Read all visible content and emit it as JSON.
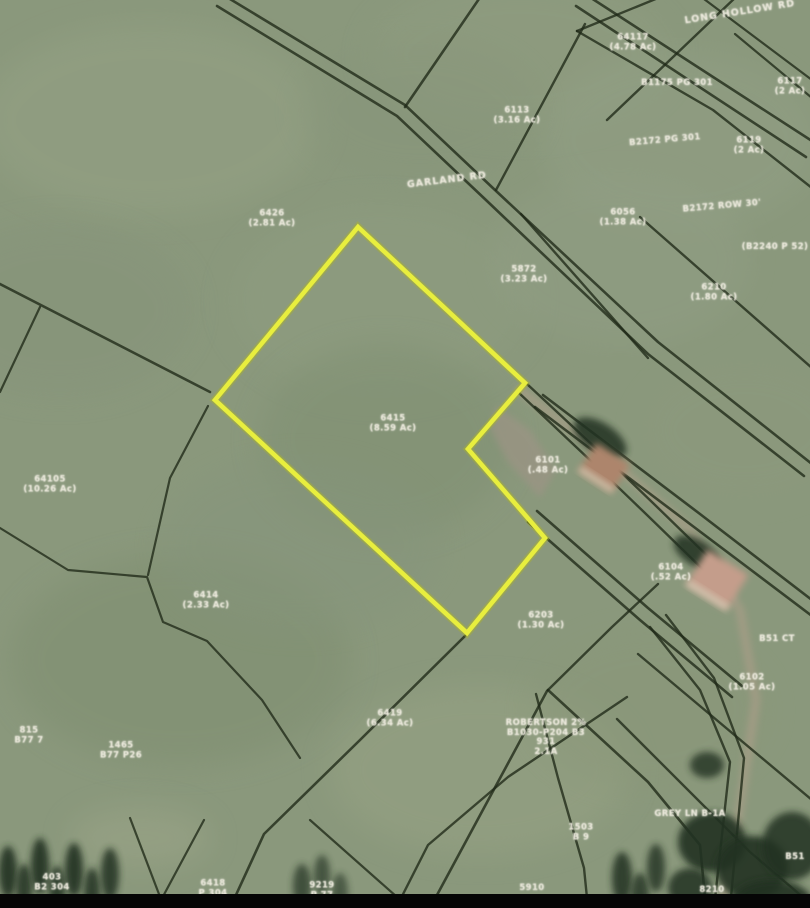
{
  "map": {
    "width": 810,
    "height": 908,
    "colors": {
      "field_base": "#8a987c",
      "boundary_line": "#1f2917",
      "highlight_yellow": "#e8ee3e",
      "highlight_glow": "#aab32a",
      "road_surface": "#a59d86",
      "driveway_grey": "#9b9484",
      "tree_dark": "#243120",
      "roof_1": "#ad856c",
      "roof_2": "#c49d8b",
      "roof_edge": "#d9d2bc",
      "bottom_bar": "#060606",
      "label_text": "#ece9dc"
    },
    "field_blobs": [
      {
        "x": 150,
        "y": 120,
        "rx": 170,
        "ry": 95,
        "fill": "#94a184",
        "o": 0.55
      },
      {
        "x": 520,
        "y": 55,
        "rx": 150,
        "ry": 75,
        "fill": "#909d81",
        "o": 0.5
      },
      {
        "x": 60,
        "y": 310,
        "rx": 130,
        "ry": 85,
        "fill": "#85937a",
        "o": 0.5
      },
      {
        "x": 680,
        "y": 140,
        "rx": 140,
        "ry": 90,
        "fill": "#93a086",
        "o": 0.45
      },
      {
        "x": 380,
        "y": 300,
        "rx": 150,
        "ry": 95,
        "fill": "#8e9c80",
        "o": 0.5
      },
      {
        "x": 385,
        "y": 440,
        "rx": 125,
        "ry": 95,
        "fill": "#7f8f72",
        "o": 0.5
      },
      {
        "x": 620,
        "y": 260,
        "rx": 130,
        "ry": 85,
        "fill": "#929f85",
        "o": 0.45
      },
      {
        "x": 745,
        "y": 430,
        "rx": 105,
        "ry": 70,
        "fill": "#8d9a7e",
        "o": 0.45
      },
      {
        "x": 180,
        "y": 660,
        "rx": 170,
        "ry": 105,
        "fill": "#7e8d70",
        "o": 0.5
      },
      {
        "x": 300,
        "y": 545,
        "rx": 140,
        "ry": 85,
        "fill": "#85947b",
        "o": 0.45
      },
      {
        "x": 480,
        "y": 770,
        "rx": 150,
        "ry": 85,
        "fill": "#97a384",
        "o": 0.5
      },
      {
        "x": 140,
        "y": 838,
        "rx": 70,
        "ry": 30,
        "fill": "#9da689",
        "o": 0.5
      },
      {
        "x": 650,
        "y": 710,
        "rx": 120,
        "ry": 80,
        "fill": "#8a9779",
        "o": 0.45
      },
      {
        "x": 420,
        "y": 110,
        "rx": 120,
        "ry": 70,
        "fill": "#87957a",
        "o": 0.4
      }
    ],
    "road_strip": {
      "points": [
        [
          520,
          390
        ],
        [
          610,
          460
        ],
        [
          690,
          530
        ],
        [
          740,
          610
        ],
        [
          756,
          700
        ],
        [
          738,
          820
        ],
        [
          722,
          908
        ]
      ],
      "width": 9
    },
    "driveway": {
      "points": [
        [
          497,
          406
        ],
        [
          530,
          430
        ],
        [
          556,
          470
        ],
        [
          540,
          498
        ],
        [
          508,
          462
        ],
        [
          490,
          428
        ]
      ]
    },
    "boundary_lines": [
      {
        "p": [
          [
            225,
            -4
          ],
          [
            405,
            105
          ],
          [
            495,
            190
          ],
          [
            658,
            342
          ],
          [
            812,
            464
          ]
        ],
        "w": 2.6
      },
      {
        "p": [
          [
            217,
            6
          ],
          [
            397,
            116
          ],
          [
            487,
            201
          ],
          [
            648,
            354
          ],
          [
            804,
            476
          ]
        ],
        "w": 2.6
      },
      {
        "p": [
          [
            588,
            -4
          ],
          [
            812,
            141
          ]
        ],
        "w": 2.6
      },
      {
        "p": [
          [
            576,
            6
          ],
          [
            806,
            157
          ]
        ],
        "w": 2.6
      },
      {
        "p": [
          [
            543,
            395
          ],
          [
            700,
            514
          ],
          [
            812,
            600
          ]
        ],
        "w": 2.6
      },
      {
        "p": [
          [
            535,
            407
          ],
          [
            694,
            527
          ],
          [
            812,
            616
          ]
        ],
        "w": 2.6
      },
      {
        "p": [
          [
            537,
            511
          ],
          [
            648,
            608
          ],
          [
            742,
            686
          ]
        ],
        "w": 2.6
      },
      {
        "p": [
          [
            528,
            522
          ],
          [
            640,
            620
          ],
          [
            732,
            697
          ]
        ],
        "w": 2.6
      },
      {
        "p": [
          [
            666,
            615
          ],
          [
            714,
            678
          ],
          [
            744,
            758
          ],
          [
            730,
            908
          ]
        ],
        "w": 2.4
      },
      {
        "p": [
          [
            650,
            627
          ],
          [
            700,
            690
          ],
          [
            730,
            762
          ],
          [
            714,
            908
          ]
        ],
        "w": 2.4
      },
      {
        "p": [
          [
            527,
            384
          ],
          [
            600,
            452
          ],
          [
            654,
            504
          ],
          [
            726,
            574
          ]
        ],
        "w": 2.4
      },
      {
        "p": [
          [
            519,
            393
          ],
          [
            592,
            462
          ],
          [
            646,
            514
          ],
          [
            718,
            584
          ]
        ],
        "w": 2.4
      },
      {
        "p": [
          [
            0,
            284
          ],
          [
            210,
            392
          ]
        ],
        "w": 2.6
      },
      {
        "p": [
          [
            40,
            307
          ],
          [
            0,
            392
          ]
        ],
        "w": 2.2
      },
      {
        "p": [
          [
            208,
            406
          ],
          [
            170,
            478
          ],
          [
            148,
            575
          ]
        ],
        "w": 2.2
      },
      {
        "p": [
          [
            0,
            528
          ],
          [
            68,
            570
          ],
          [
            147,
            577
          ],
          [
            163,
            622
          ],
          [
            207,
            641
          ],
          [
            262,
            700
          ],
          [
            300,
            758
          ]
        ],
        "w": 2.2
      },
      {
        "p": [
          [
            465,
            636
          ],
          [
            360,
            740
          ],
          [
            264,
            834
          ],
          [
            230,
            908
          ]
        ],
        "w": 2.6
      },
      {
        "p": [
          [
            547,
            691
          ],
          [
            430,
            908
          ]
        ],
        "w": 2.6
      },
      {
        "p": [
          [
            548,
            690
          ],
          [
            648,
            782
          ],
          [
            700,
            845
          ],
          [
            706,
            908
          ]
        ],
        "w": 2.6
      },
      {
        "p": [
          [
            627,
            697
          ],
          [
            508,
            777
          ],
          [
            428,
            845
          ],
          [
            396,
            908
          ]
        ],
        "w": 2.4
      },
      {
        "p": [
          [
            536,
            694
          ],
          [
            558,
            778
          ],
          [
            584,
            868
          ],
          [
            588,
            908
          ]
        ],
        "w": 2.4
      },
      {
        "p": [
          [
            548,
            690
          ],
          [
            612,
            627
          ],
          [
            658,
            584
          ]
        ],
        "w": 2.4
      },
      {
        "p": [
          [
            521,
            214
          ],
          [
            648,
            358
          ]
        ],
        "w": 2.4
      },
      {
        "p": [
          [
            640,
            217
          ],
          [
            812,
            368
          ]
        ],
        "w": 2.4
      },
      {
        "p": [
          [
            481,
            -4
          ],
          [
            405,
            107
          ]
        ],
        "w": 2.6
      },
      {
        "p": [
          [
            585,
            24
          ],
          [
            496,
            190
          ]
        ],
        "w": 2.4
      },
      {
        "p": [
          [
            577,
            31
          ],
          [
            713,
            110
          ],
          [
            812,
            188
          ]
        ],
        "w": 2.4
      },
      {
        "p": [
          [
            607,
            120
          ],
          [
            737,
            -4
          ]
        ],
        "w": 2.4
      },
      {
        "p": [
          [
            735,
            34
          ],
          [
            812,
            98
          ]
        ],
        "w": 2.2
      },
      {
        "p": [
          [
            663,
            -4
          ],
          [
            577,
            31
          ]
        ],
        "w": 2.4
      },
      {
        "p": [
          [
            700,
            -4
          ],
          [
            812,
            80
          ]
        ],
        "w": 2.2
      },
      {
        "p": [
          [
            638,
            654
          ],
          [
            812,
            800
          ]
        ],
        "w": 2.4
      },
      {
        "p": [
          [
            617,
            719
          ],
          [
            750,
            852
          ],
          [
            812,
            905
          ]
        ],
        "w": 2.4
      },
      {
        "p": [
          [
            130,
            818
          ],
          [
            162,
            902
          ]
        ],
        "w": 2.2
      },
      {
        "p": [
          [
            204,
            820
          ],
          [
            160,
            902
          ]
        ],
        "w": 2.2
      },
      {
        "p": [
          [
            310,
            820
          ],
          [
            397,
            897
          ]
        ],
        "w": 2.2
      }
    ],
    "highlight_parcel": {
      "points": [
        [
          358,
          227
        ],
        [
          525,
          383
        ],
        [
          468,
          449
        ],
        [
          545,
          538
        ],
        [
          467,
          633
        ],
        [
          215,
          400
        ]
      ],
      "stroke_width": 4.6
    },
    "houses": [
      {
        "cx": 604,
        "cy": 468,
        "w": 40,
        "h": 34,
        "rot": 33,
        "fill": "#ad856c"
      },
      {
        "cx": 717,
        "cy": 580,
        "w": 48,
        "h": 42,
        "rot": 32,
        "fill": "#c49d8b"
      }
    ],
    "tree_blobs": [
      {
        "x": 600,
        "y": 438,
        "rx": 30,
        "ry": 15,
        "rot": 33,
        "o": 0.85
      },
      {
        "x": 697,
        "y": 553,
        "rx": 26,
        "ry": 13,
        "rot": 32,
        "o": 0.85
      },
      {
        "x": 707,
        "y": 765,
        "rx": 17,
        "ry": 13,
        "rot": 0,
        "o": 0.8
      },
      {
        "x": 8,
        "y": 872,
        "rx": 9,
        "ry": 26,
        "rot": 0,
        "o": 0.9
      },
      {
        "x": 24,
        "y": 888,
        "rx": 8,
        "ry": 24,
        "rot": 0,
        "o": 0.85
      },
      {
        "x": 40,
        "y": 866,
        "rx": 9,
        "ry": 28,
        "rot": 0,
        "o": 0.9
      },
      {
        "x": 57,
        "y": 890,
        "rx": 8,
        "ry": 24,
        "rot": 0,
        "o": 0.85
      },
      {
        "x": 74,
        "y": 870,
        "rx": 9,
        "ry": 27,
        "rot": 0,
        "o": 0.9
      },
      {
        "x": 92,
        "y": 892,
        "rx": 8,
        "ry": 24,
        "rot": 0,
        "o": 0.85
      },
      {
        "x": 110,
        "y": 874,
        "rx": 9,
        "ry": 26,
        "rot": 0,
        "o": 0.85
      },
      {
        "x": 302,
        "y": 886,
        "rx": 9,
        "ry": 22,
        "rot": 0,
        "o": 0.7
      },
      {
        "x": 322,
        "y": 875,
        "rx": 8,
        "ry": 20,
        "rot": 0,
        "o": 0.65
      },
      {
        "x": 340,
        "y": 893,
        "rx": 8,
        "ry": 20,
        "rot": 0,
        "o": 0.6
      },
      {
        "x": 622,
        "y": 878,
        "rx": 10,
        "ry": 26,
        "rot": 0,
        "o": 0.85
      },
      {
        "x": 640,
        "y": 895,
        "rx": 9,
        "ry": 22,
        "rot": 0,
        "o": 0.8
      },
      {
        "x": 656,
        "y": 868,
        "rx": 9,
        "ry": 24,
        "rot": 0,
        "o": 0.8
      },
      {
        "x": 712,
        "y": 842,
        "rx": 34,
        "ry": 30,
        "rot": 0,
        "o": 0.9
      },
      {
        "x": 752,
        "y": 868,
        "rx": 36,
        "ry": 32,
        "rot": 0,
        "o": 0.9
      },
      {
        "x": 792,
        "y": 846,
        "rx": 30,
        "ry": 34,
        "rot": 0,
        "o": 0.85
      },
      {
        "x": 772,
        "y": 902,
        "rx": 40,
        "ry": 22,
        "rot": 0,
        "o": 0.9
      },
      {
        "x": 690,
        "y": 888,
        "rx": 22,
        "ry": 20,
        "rot": 0,
        "o": 0.85
      }
    ],
    "bottom_bar": {
      "height": 14
    }
  },
  "labels": [
    {
      "x": 272,
      "y": 219,
      "rot": 0,
      "kind": "parcel",
      "lines": [
        "6426",
        "(2.81 Ac)"
      ]
    },
    {
      "x": 447,
      "y": 181,
      "rot": -7,
      "kind": "road",
      "lines": [
        "GARLAND RD"
      ]
    },
    {
      "x": 524,
      "y": 275,
      "rot": 0,
      "kind": "parcel",
      "lines": [
        "5872",
        "(3.23 Ac)"
      ]
    },
    {
      "x": 633,
      "y": 43,
      "rot": 0,
      "kind": "parcel",
      "lines": [
        "64117",
        "(4.78 Ac)"
      ]
    },
    {
      "x": 740,
      "y": 13,
      "rot": -9,
      "kind": "road",
      "lines": [
        "LONG HOLLOW RD"
      ]
    },
    {
      "x": 790,
      "y": 87,
      "rot": 0,
      "kind": "parcel",
      "lines": [
        "6117",
        "(2 Ac)"
      ]
    },
    {
      "x": 677,
      "y": 84,
      "rot": 0,
      "kind": "parcel",
      "lines": [
        "B1175 PG 301"
      ]
    },
    {
      "x": 749,
      "y": 146,
      "rot": 0,
      "kind": "parcel",
      "lines": [
        "6119",
        "(2 Ac)"
      ]
    },
    {
      "x": 665,
      "y": 141,
      "rot": -5,
      "kind": "parcel",
      "lines": [
        "B2172 PG 301"
      ]
    },
    {
      "x": 623,
      "y": 218,
      "rot": 0,
      "kind": "parcel",
      "lines": [
        "6056",
        "(1.38 Ac)"
      ]
    },
    {
      "x": 722,
      "y": 207,
      "rot": -5,
      "kind": "parcel",
      "lines": [
        "B2172 ROW 30'"
      ]
    },
    {
      "x": 775,
      "y": 248,
      "rot": 0,
      "kind": "parcel",
      "lines": [
        "(B2240 P 52)"
      ]
    },
    {
      "x": 714,
      "y": 293,
      "rot": 0,
      "kind": "parcel",
      "lines": [
        "6210",
        "(1.80 Ac)"
      ]
    },
    {
      "x": 517,
      "y": 116,
      "rot": 0,
      "kind": "parcel",
      "lines": [
        "6113",
        "(3.16 Ac)"
      ]
    },
    {
      "x": 393,
      "y": 424,
      "rot": 0,
      "kind": "parcel",
      "lines": [
        "6415",
        "(8.59 Ac)"
      ]
    },
    {
      "x": 548,
      "y": 466,
      "rot": 0,
      "kind": "parcel",
      "lines": [
        "6101",
        "(.48 Ac)"
      ]
    },
    {
      "x": 50,
      "y": 485,
      "rot": 0,
      "kind": "parcel",
      "lines": [
        "64105",
        "(10.26 Ac)"
      ]
    },
    {
      "x": 206,
      "y": 601,
      "rot": 0,
      "kind": "parcel",
      "lines": [
        "6414",
        "(2.33 Ac)"
      ]
    },
    {
      "x": 541,
      "y": 621,
      "rot": 0,
      "kind": "parcel",
      "lines": [
        "6203",
        "(1.30 Ac)"
      ]
    },
    {
      "x": 671,
      "y": 573,
      "rot": 0,
      "kind": "parcel",
      "lines": [
        "6104",
        "(.52 Ac)"
      ]
    },
    {
      "x": 752,
      "y": 683,
      "rot": 0,
      "kind": "parcel",
      "lines": [
        "6102",
        "(1.05 Ac)"
      ]
    },
    {
      "x": 390,
      "y": 719,
      "rot": 0,
      "kind": "parcel",
      "lines": [
        "6419",
        "(6.34 Ac)"
      ]
    },
    {
      "x": 546,
      "y": 738,
      "rot": 0,
      "kind": "parcel",
      "lines": [
        "ROBERTSON 2%",
        "B1030-P204 B3",
        "931",
        "2.1A"
      ]
    },
    {
      "x": 121,
      "y": 751,
      "rot": 0,
      "kind": "parcel",
      "lines": [
        "1465",
        "B77 P26"
      ]
    },
    {
      "x": 29,
      "y": 736,
      "rot": 0,
      "kind": "parcel",
      "lines": [
        "815",
        "B77 7"
      ]
    },
    {
      "x": 690,
      "y": 815,
      "rot": 0,
      "kind": "parcel",
      "lines": [
        "GREY LN B-1A"
      ]
    },
    {
      "x": 581,
      "y": 833,
      "rot": 0,
      "kind": "parcel",
      "lines": [
        "1503",
        "B 9"
      ]
    },
    {
      "x": 52,
      "y": 883,
      "rot": 0,
      "kind": "parcel",
      "lines": [
        "403",
        "B2 304"
      ]
    },
    {
      "x": 213,
      "y": 889,
      "rot": 0,
      "kind": "parcel",
      "lines": [
        "6418",
        "P 304"
      ]
    },
    {
      "x": 322,
      "y": 891,
      "rot": 0,
      "kind": "parcel",
      "lines": [
        "9219",
        "P 77"
      ]
    },
    {
      "x": 532,
      "y": 889,
      "rot": 0,
      "kind": "parcel",
      "lines": [
        "5910"
      ]
    },
    {
      "x": 777,
      "y": 640,
      "rot": 0,
      "kind": "parcel",
      "lines": [
        "B51 CT"
      ]
    },
    {
      "x": 795,
      "y": 858,
      "rot": 0,
      "kind": "parcel",
      "lines": [
        "B51"
      ]
    },
    {
      "x": 712,
      "y": 891,
      "rot": 0,
      "kind": "parcel",
      "lines": [
        "8210"
      ]
    }
  ]
}
